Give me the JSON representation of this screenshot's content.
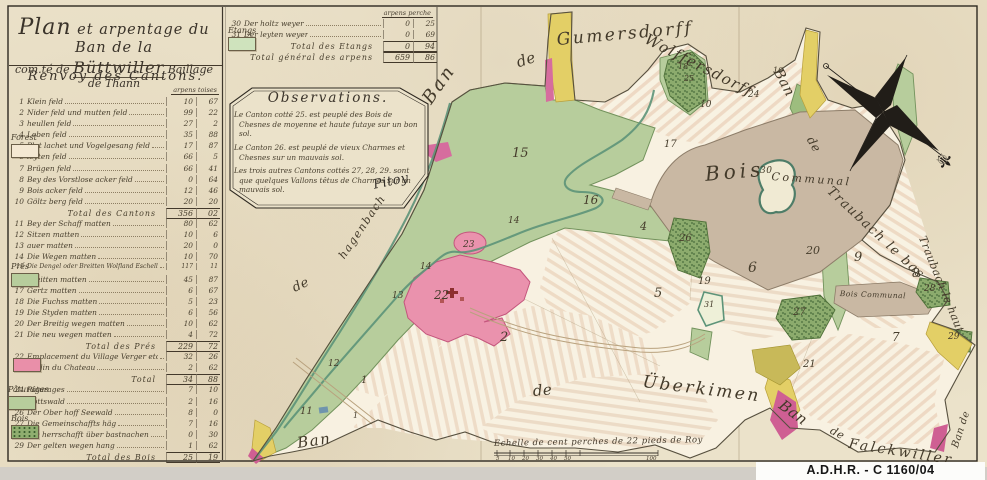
{
  "archive": {
    "label": "A.D.H.R.  -  C 1160/04"
  },
  "title": {
    "line1_initial": "Plan",
    "line1_rest": " et arpentage du Ban de la",
    "line2_pre": "com.té de ",
    "line2_name": "Büttwiller",
    "line2_post": " Baillage de Thann"
  },
  "renvoy": {
    "heading": "Renvoy des Cantons.",
    "col_header": "arpens  toises",
    "rows": [
      {
        "n": "1",
        "label": "Klein feld",
        "a": "10",
        "t": "67"
      },
      {
        "n": "2",
        "label": "Nider feld und mutten feld",
        "a": "99",
        "t": "22"
      },
      {
        "n": "3",
        "label": "heullen feld",
        "a": "27",
        "t": "2"
      },
      {
        "n": "4",
        "label": "Leben feld",
        "a": "35",
        "t": "88"
      },
      {
        "n": "5",
        "label": "Plat lachet und Vogelgesang feld",
        "a": "17",
        "t": "87"
      },
      {
        "n": "6",
        "label": "leyten feld",
        "a": "66",
        "t": "5"
      },
      {
        "n": "7",
        "label": "Brügen feld",
        "a": "66",
        "t": "41"
      },
      {
        "n": "8",
        "label": "Bey des Vorstlose acker feld",
        "a": "0",
        "t": "64"
      },
      {
        "n": "9",
        "label": "Bois acker feld",
        "a": "12",
        "t": "46"
      },
      {
        "n": "10",
        "label": "Göltz berg feld",
        "a": "20",
        "t": "20"
      },
      {
        "n": "",
        "label": "Total des Cantons",
        "a": "356",
        "t": "02",
        "cls": "total"
      },
      {
        "n": "11",
        "label": "Bey der Schaff matten",
        "a": "80",
        "t": "62"
      },
      {
        "n": "12",
        "label": "Sitzen matten",
        "a": "10",
        "t": "6"
      },
      {
        "n": "13",
        "label": "auer matten",
        "a": "20",
        "t": "0"
      },
      {
        "n": "14",
        "label": "Die Wegen matten",
        "a": "10",
        "t": "70"
      },
      {
        "n": "15",
        "label": "Die Dengel oder Breitten Wolfland Eschell matten",
        "a": "117",
        "t": "11",
        "cls": "tiny"
      },
      {
        "n": "16",
        "label": "Breitten matten",
        "a": "45",
        "t": "87"
      },
      {
        "n": "17",
        "label": "Gertz matten",
        "a": "6",
        "t": "67"
      },
      {
        "n": "18",
        "label": "Die Fuchss matten",
        "a": "5",
        "t": "23"
      },
      {
        "n": "19",
        "label": "Die Styden matten",
        "a": "6",
        "t": "56"
      },
      {
        "n": "20",
        "label": "Der Breitig wegen matten",
        "a": "10",
        "t": "62"
      },
      {
        "n": "21",
        "label": "Die neu wegen matten",
        "a": "4",
        "t": "72"
      },
      {
        "n": "",
        "label": "Total des Prés",
        "a": "229",
        "t": "72",
        "cls": "total"
      },
      {
        "n": "22",
        "label": "Emplacement du Village Verger etc.",
        "a": "32",
        "t": "26"
      },
      {
        "n": "23",
        "label": "Jardin du Chateau",
        "a": "2",
        "t": "62"
      },
      {
        "n": "",
        "label": "Total",
        "a": "34",
        "t": "88",
        "cls": "total"
      },
      {
        "n": "24",
        "label": "Pâturages",
        "a": "7",
        "t": "10"
      },
      {
        "n": "25",
        "label": "Gottswald",
        "a": "2",
        "t": "16"
      },
      {
        "n": "26",
        "label": "Der Ober hoff Seewald",
        "a": "8",
        "t": "0"
      },
      {
        "n": "27",
        "label": "Die Gemeinschaffts häg",
        "a": "7",
        "t": "16"
      },
      {
        "n": "28",
        "label": "Die herrschafft über bastnachen",
        "a": "0",
        "t": "30"
      },
      {
        "n": "29",
        "label": "Der gelten wegen hang",
        "a": "1",
        "t": "62"
      },
      {
        "n": "",
        "label": "Total des Bois",
        "a": "25",
        "t": "19",
        "cls": "total"
      }
    ]
  },
  "categories": [
    {
      "label": "Forest",
      "x": 11,
      "y": 133,
      "cls": "cat-blank"
    },
    {
      "label": "Prés",
      "x": 11,
      "y": 262,
      "cls": "cat-green"
    },
    {
      "label": "",
      "x": 13,
      "y": 356,
      "cls": "cat-pink"
    },
    {
      "label": "Pâturages",
      "x": 8,
      "y": 385,
      "cls": "cat-green"
    },
    {
      "label": "Bois",
      "x": 11,
      "y": 414,
      "cls": "cat-trees"
    },
    {
      "label": "Étangs",
      "x": 228,
      "y": 26,
      "cls": "cat-etang"
    }
  ],
  "etangs": {
    "col_header": "arpens  perche",
    "rows": [
      {
        "n": "30",
        "label": "Der holtz weyer",
        "a": "0",
        "t": "25"
      },
      {
        "n": "31",
        "label": "Der leyten weyer",
        "a": "0",
        "t": "69"
      },
      {
        "n": "",
        "label": "Total des Etangs",
        "a": "0",
        "t": "94",
        "cls": "total"
      },
      {
        "n": "",
        "label": "Total général des arpens",
        "a": "659",
        "t": "86",
        "cls": "total"
      }
    ]
  },
  "observations": {
    "title": "Observations.",
    "paras": [
      "Le Canton cotté 25. est peuplé des Bois de Chesnes de moyenne et haute futaye sur un bon sol.",
      "Le Canton 26. est peuplé de vieux Charmes et Chesnes sur un mauvais sol.",
      "Les trois autres Cantons cottés 27, 28, 29. sont que quelques Vallons têtus de Charmes sur un mauvais sol."
    ],
    "signature": "Pitoy"
  },
  "map": {
    "labels": [
      {
        "text": "Ban",
        "x": 418,
        "y": 96,
        "rot": -55,
        "size": 18,
        "cls": "ls2"
      },
      {
        "text": "de",
        "x": 514,
        "y": 54,
        "rot": -18,
        "size": 15
      },
      {
        "text": "Gumersdorff",
        "x": 556,
        "y": 30,
        "rot": -5,
        "size": 17,
        "cls": "ls2"
      },
      {
        "text": "Wolffersdorff",
        "x": 650,
        "y": 30,
        "rot": 27,
        "size": 15,
        "cls": "ls1"
      },
      {
        "text": "Ban",
        "x": 784,
        "y": 66,
        "rot": 62,
        "size": 14
      },
      {
        "text": "de",
        "x": 816,
        "y": 134,
        "rot": 60,
        "size": 12
      },
      {
        "text": "Traubach le bas",
        "x": 834,
        "y": 184,
        "rot": 43,
        "size": 13,
        "cls": "ls1"
      },
      {
        "text": "Traubach le haut",
        "x": 928,
        "y": 234,
        "rot": 68,
        "size": 11
      },
      {
        "text": "Bois",
        "x": 704,
        "y": 162,
        "rot": -5,
        "size": 20,
        "cls": "ls3"
      },
      {
        "text": "30",
        "x": 760,
        "y": 166,
        "size": 9
      },
      {
        "text": "Communal",
        "x": 772,
        "y": 170,
        "rot": 4,
        "size": 11,
        "cls": "ls2"
      },
      {
        "text": "Bois Communal",
        "x": 840,
        "y": 289,
        "rot": 2,
        "size": 7.5
      },
      {
        "text": "de",
        "x": 532,
        "y": 382,
        "rot": -5,
        "size": 15
      },
      {
        "text": "Überkimen",
        "x": 644,
        "y": 372,
        "rot": 7,
        "size": 17,
        "cls": "ls2"
      },
      {
        "text": "Ban",
        "x": 786,
        "y": 396,
        "rot": 36,
        "size": 15
      },
      {
        "text": "de",
        "x": 834,
        "y": 424,
        "rot": 28,
        "size": 11
      },
      {
        "text": "Falckwiller",
        "x": 850,
        "y": 436,
        "rot": 9,
        "size": 14,
        "cls": "ls2"
      },
      {
        "text": "Ban de",
        "x": 950,
        "y": 446,
        "rot": -72,
        "size": 10
      },
      {
        "text": "Ban",
        "x": 296,
        "y": 434,
        "rot": -8,
        "size": 15,
        "cls": "ls1"
      },
      {
        "text": "de",
        "x": 290,
        "y": 282,
        "rot": -25,
        "size": 13
      },
      {
        "text": "hagenbach",
        "x": 336,
        "y": 254,
        "rot": -56,
        "size": 11,
        "cls": "ls1"
      },
      {
        "text": "Pitoy",
        "x": 372,
        "y": 178,
        "rot": -12,
        "size": 13,
        "cls": "sig"
      }
    ],
    "numbers": [
      {
        "text": "15",
        "x": 512,
        "y": 146,
        "size": 13
      },
      {
        "text": "16",
        "x": 583,
        "y": 193,
        "size": 12
      },
      {
        "text": "17",
        "x": 664,
        "y": 139,
        "size": 10
      },
      {
        "text": "18",
        "x": 678,
        "y": 62,
        "size": 8
      },
      {
        "text": "25",
        "x": 684,
        "y": 74,
        "size": 8
      },
      {
        "text": "10",
        "x": 700,
        "y": 100,
        "size": 9
      },
      {
        "text": "24",
        "x": 748,
        "y": 90,
        "size": 9
      },
      {
        "text": "10",
        "x": 773,
        "y": 66,
        "size": 8
      },
      {
        "text": "4",
        "x": 640,
        "y": 220,
        "size": 11
      },
      {
        "text": "26",
        "x": 679,
        "y": 233,
        "size": 10
      },
      {
        "text": "5",
        "x": 654,
        "y": 286,
        "size": 13
      },
      {
        "text": "19",
        "x": 698,
        "y": 276,
        "size": 10
      },
      {
        "text": "31",
        "x": 704,
        "y": 300,
        "size": 8
      },
      {
        "text": "6",
        "x": 748,
        "y": 260,
        "size": 14
      },
      {
        "text": "20",
        "x": 806,
        "y": 244,
        "size": 11
      },
      {
        "text": "9",
        "x": 854,
        "y": 250,
        "size": 13
      },
      {
        "text": "8",
        "x": 912,
        "y": 266,
        "size": 12
      },
      {
        "text": "28",
        "x": 924,
        "y": 284,
        "size": 9
      },
      {
        "text": "7",
        "x": 892,
        "y": 330,
        "size": 12
      },
      {
        "text": "29",
        "x": 948,
        "y": 332,
        "size": 9
      },
      {
        "text": "27",
        "x": 793,
        "y": 307,
        "size": 10
      },
      {
        "text": "21",
        "x": 803,
        "y": 359,
        "size": 10
      },
      {
        "text": "2",
        "x": 500,
        "y": 330,
        "size": 13
      },
      {
        "text": "22",
        "x": 434,
        "y": 288,
        "size": 12
      },
      {
        "text": "23",
        "x": 463,
        "y": 240,
        "size": 9
      },
      {
        "text": "14",
        "x": 420,
        "y": 262,
        "size": 9
      },
      {
        "text": "14",
        "x": 508,
        "y": 216,
        "size": 9
      },
      {
        "text": "13",
        "x": 392,
        "y": 291,
        "size": 9
      },
      {
        "text": "12",
        "x": 328,
        "y": 359,
        "size": 9
      },
      {
        "text": "11",
        "x": 300,
        "y": 406,
        "size": 10
      },
      {
        "text": "1",
        "x": 361,
        "y": 375,
        "size": 10
      },
      {
        "text": "1",
        "x": 353,
        "y": 411,
        "size": 8
      }
    ],
    "scale": {
      "label": "Echelle de cent perches de 22 pieds de Roy",
      "ticks": [
        {
          "t": "5",
          "x": 496
        },
        {
          "t": "10",
          "x": 508
        },
        {
          "t": "20",
          "x": 522
        },
        {
          "t": "30",
          "x": 536
        },
        {
          "t": "40",
          "x": 550
        },
        {
          "t": "50",
          "x": 564
        },
        {
          "t": "100",
          "x": 646
        }
      ]
    }
  },
  "colors": {
    "meadow": "#b7cd9c",
    "bois": "#c9b8a3",
    "village": "#ea92ad",
    "water": "#5d9479",
    "yellow": "#e3cf66",
    "magenta": "#d6689c",
    "trees": "#86a868",
    "paper": "#ebe2ca",
    "ink": "#3f382d"
  }
}
